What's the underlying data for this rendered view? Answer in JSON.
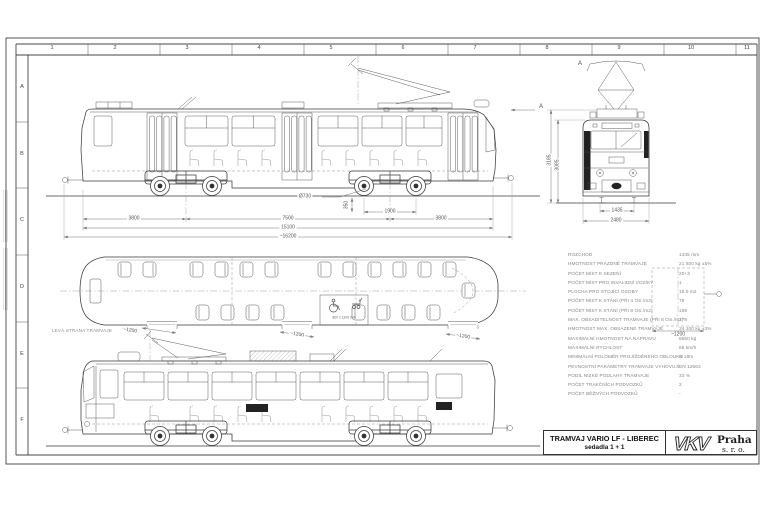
{
  "sheet": {
    "columns": [
      "1",
      "2",
      "3",
      "4",
      "5",
      "6",
      "7",
      "8",
      "9",
      "10",
      "11"
    ],
    "rows": [
      "A",
      "B",
      "C",
      "D",
      "E",
      "F"
    ]
  },
  "dimensions": {
    "side_view": {
      "left_overhang": "3800",
      "pivot_spacing": "7500",
      "wheelbase": "1900",
      "right_overhang": "3800",
      "body_length": "15100",
      "total_length": "~16200",
      "wheel_dia": "Ø730",
      "floor_height": "350"
    },
    "front_view": {
      "height_pantograph": "3185",
      "height_roof": "3085",
      "gauge": "1435",
      "width": "2480",
      "view_label": "A"
    },
    "plan_view": {
      "door1": "~1200",
      "door2": "~1200",
      "door3": "~1200",
      "door4": "~1200",
      "wheelchair": "800 x 1200 mm",
      "caption": "LEVÁ STRANA TRAMVAJE"
    }
  },
  "annotations": {
    "view_arrow": "A"
  },
  "spec_table": {
    "rows": [
      {
        "label": "ROZCHOD",
        "value": "1435 mm"
      },
      {
        "label": "HMOTNOST PRÁZDNÉ TRAMVAJE",
        "value": "21 500 kg ±5%"
      },
      {
        "label": "POČET MÍST K SEZENÍ",
        "value": "20+3"
      },
      {
        "label": "POČET MÍST PRO INVALIDNÍ VOZÍKY",
        "value": "1"
      },
      {
        "label": "PLOCHA PRO STOJÍCÍ OSOBY",
        "value": "16,9 m2"
      },
      {
        "label": "POČET MÍST K STÁNÍ (PŘI 4 OS./m2)",
        "value": "79"
      },
      {
        "label": "POČET MÍST K STÁNÍ (PŘI 8 OS./m2)",
        "value": "159"
      },
      {
        "label": "MAX. OBSADITELNOST TRAMVAJE (PŘI 8 OS./m2)",
        "value": "179"
      },
      {
        "label": "HMOTNOST MAX. OBSAZENÉ TRAMVAJE",
        "value": "34 100 kg ±3%"
      },
      {
        "label": "MAXIMÁLNÍ HMOTNOST NA NÁPRAVU",
        "value": "8550 kg"
      },
      {
        "label": "MAXIMÁLNÍ RYCHLOST",
        "value": "65 km/h"
      },
      {
        "label": "MINIMÁLNÍ POLOMĚR PROJÍŽDĚNÉHO OBLOUKU",
        "value": "R 18m"
      },
      {
        "label": "PEVNOSTNÍ PARAMETRY TRAMVAJE VYHOVUJÍ",
        "value": "EN 12663"
      },
      {
        "label": "PODÍL NÍZKÉ PODLAHY TRAMVAJE",
        "value": "33 %"
      },
      {
        "label": "POČET TRAKČNÍCH PODVOZKŮ",
        "value": "2"
      },
      {
        "label": "POČET BĚŽNÝCH PODVOZKŮ",
        "value": "-"
      }
    ]
  },
  "title_block": {
    "title": "TRAMVAJ VARIO LF - LIBEREC",
    "subtitle": "sedadla 1 + 1",
    "logo": {
      "letters": "VKV",
      "name": "Praha",
      "suffix": "s. r. o."
    }
  }
}
